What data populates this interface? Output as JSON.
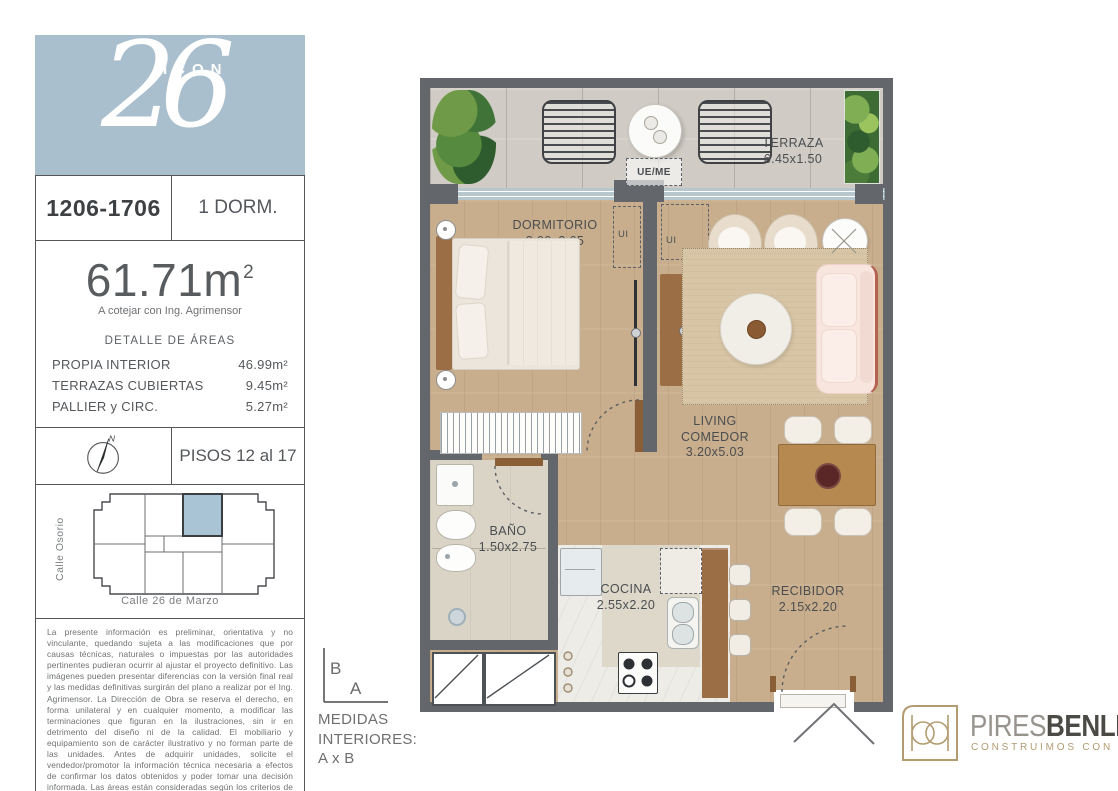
{
  "colors": {
    "logo_blue": "#a9bfce",
    "wall": "#63666b",
    "wood": "#c9ae8d",
    "concrete": "#d0ccc5",
    "tile": "#d9d4c6",
    "marble": "#eeece7",
    "window": "#b7c7ce",
    "highlight": "#a9c4d4",
    "gold": "#b39b70",
    "sofa_pink": "#f7e5de",
    "rug": "#d8c5a5",
    "furniture_wood": "#9b6e45"
  },
  "header": {
    "project_name": "ICON",
    "project_number": "26",
    "unit_numbers": "1206-1706",
    "unit_type": "1 DORM."
  },
  "area": {
    "total": "61.71m",
    "sup": "2",
    "note": "A cotejar con Ing. Agrimensor",
    "details_title": "DETALLE DE ÁREAS",
    "rows": [
      {
        "label": "PROPIA INTERIOR",
        "value": "46.99m²"
      },
      {
        "label": "TERRAZAS CUBIERTAS",
        "value": "9.45m²"
      },
      {
        "label": "PALLIER y CIRC.",
        "value": "5.27m²"
      }
    ]
  },
  "floors_label": "PISOS 12 al 17",
  "compass_n": "N",
  "map": {
    "street_left": "Calle Osorio",
    "street_bottom": "Calle 26 de Marzo"
  },
  "legal": "La presente información es preliminar, orientativa y no vinculante, quedando sujeta a las modificaciones que por causas técnicas, naturales o impuestas por las autoridades pertinentes pudieran ocurrir al ajustar el proyecto definitivo. Las imágenes pueden presentar diferencias con la versión final real y las medidas definitivas surgirán del plano a realizar por el Ing. Agrimensor. La Dirección de Obra se reserva el derecho, en forma unilateral y en cualquier momento, a modificar las terminaciones que figuran en la ilustraciones, sin ir en detrimento del diseño ni de la calidad. El mobiliario y equipamiento son de carácter ilustrativo y no forman parte de las unidades. Antes de adquirir unidades, solicite el vendedor/promotor la información técnica necesaria a efectos de confirmar los datos obtenidos y poder tomar una decisión informada. Las áreas están consideradas según los criterios de APPCU.",
  "measures": {
    "axis_b": "B",
    "axis_a": "A",
    "line1": "MEDIDAS",
    "line2": "INTERIORES:",
    "line3": "A x B"
  },
  "plan": {
    "rooms": [
      {
        "name": "TERRAZA",
        "dims": "6.45x1.50"
      },
      {
        "name": "DORMITORIO",
        "dims": "3.00x3.65"
      },
      {
        "name": "LIVING COMEDOR",
        "dims": "3.20x5.03"
      },
      {
        "name": "BAÑO",
        "dims": "1.50x2.75"
      },
      {
        "name": "COCINA",
        "dims": "2.55x2.20"
      },
      {
        "name": "RECIBIDOR",
        "dims": "2.15x2.20"
      }
    ],
    "ue_me": "UE/ME",
    "ui": "UI"
  },
  "brand": {
    "name_primary": "PIRES",
    "name_secondary": "BENLIAN",
    "tagline": "CONSTRUIMOS CON ESTILO"
  }
}
